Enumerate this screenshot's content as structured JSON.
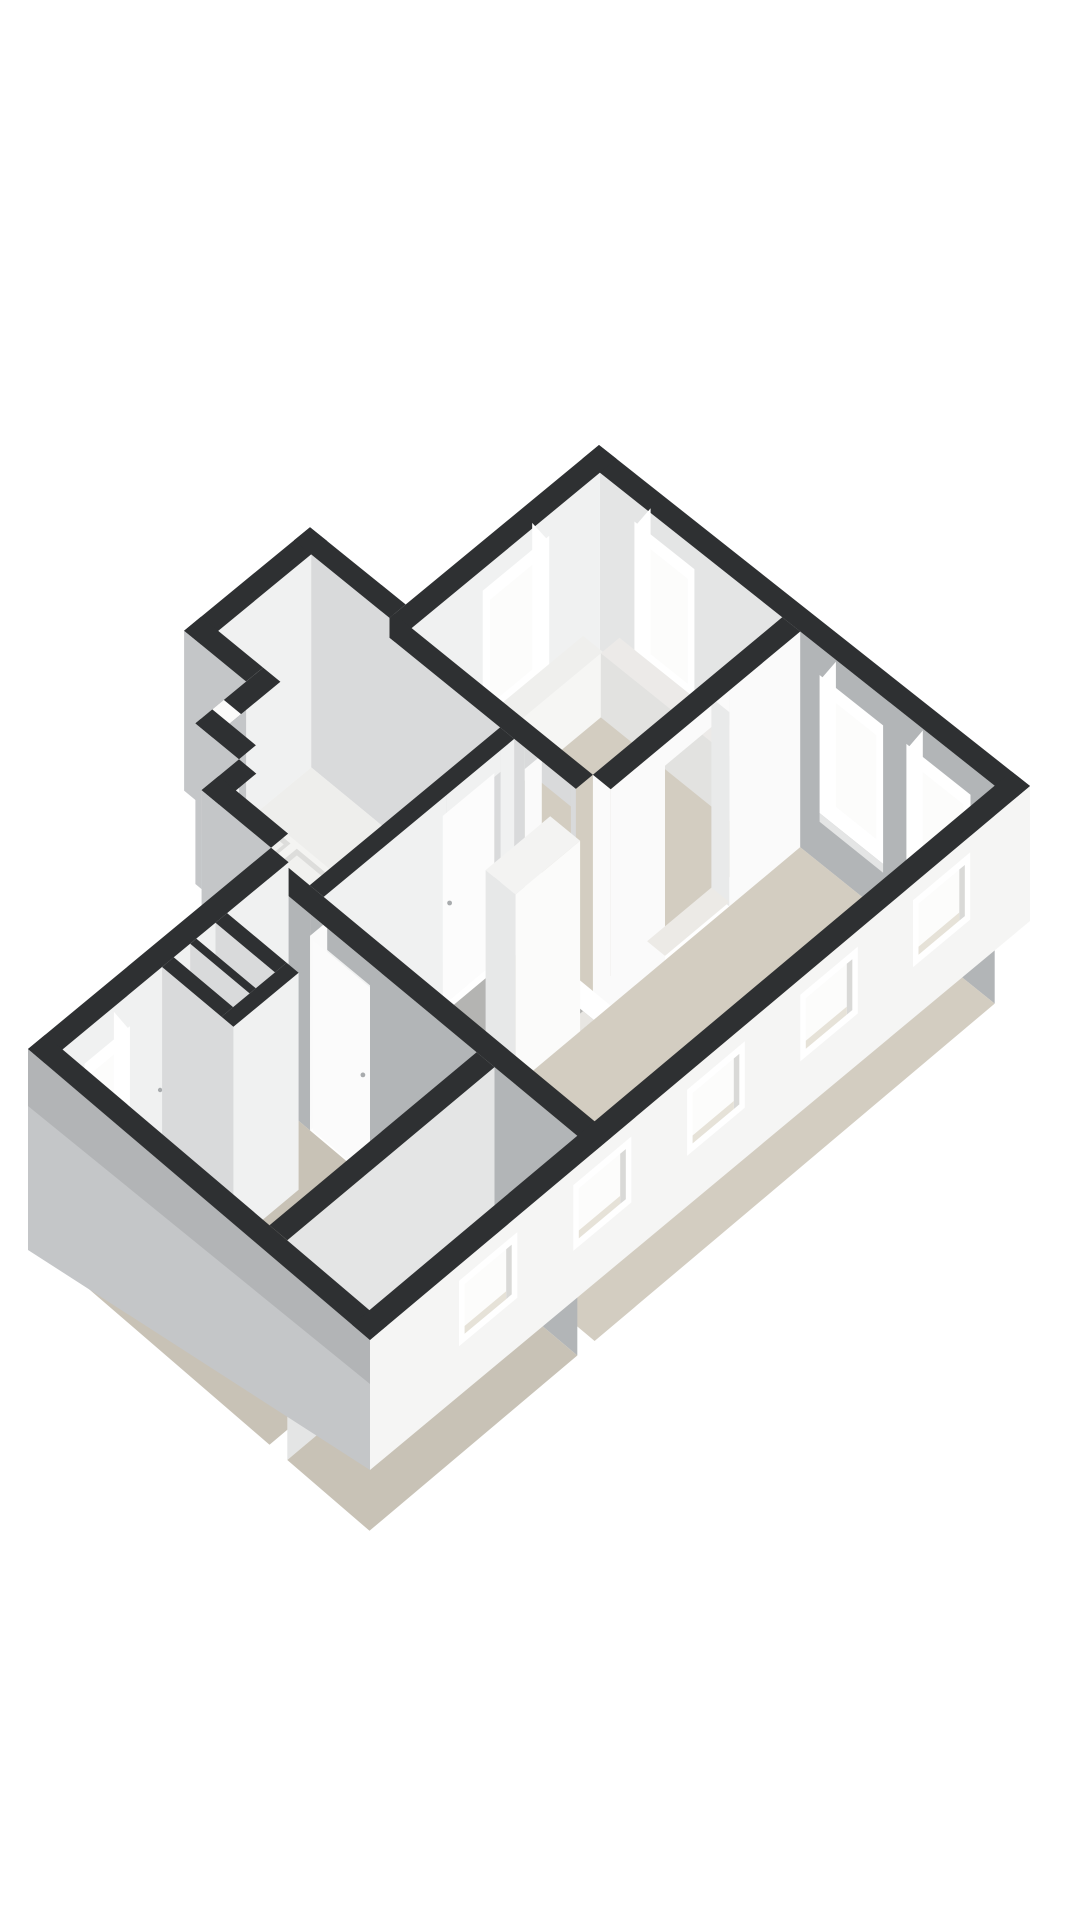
{
  "scene": {
    "description": "isometric-3d-floor-plan-render",
    "background": "#ffffff",
    "colors": {
      "wall_top": "#2e3032",
      "wall_top_edge": "#232527",
      "int_white": "#f0f1f1",
      "int_white_bright": "#fafafa",
      "int_white_dim": "#e4e5e5",
      "int_gray": "#b2b5b7",
      "int_gray_light": "#d9dadb",
      "ext_gray": "#c4c6c8",
      "ext_gray_dark": "#b2b4b6",
      "ext_white": "#f5f5f4",
      "floor_beige": "#d3cdc1",
      "floor_beige_shade": "#c8c2b6",
      "floor_gray": "#b4b4b2",
      "floor_white": "#eeeeec",
      "floor_strip": "#e8e6e2",
      "glass": "#fcfcfb",
      "frame": "#ffffff",
      "frame_line": "#d4d4d2",
      "reveal": "#e9eaea",
      "fixture": "#f6f6f5",
      "fixture_shade": "#e2e2e0",
      "metal": "#a8abad"
    },
    "rooms": [
      {
        "name": "bedroom-north",
        "floor": "beige"
      },
      {
        "name": "living-room",
        "floor": "beige"
      },
      {
        "name": "kitchen",
        "floor": "white"
      },
      {
        "name": "hallway",
        "floor": "gray"
      },
      {
        "name": "bedroom-south",
        "floor": "beige"
      },
      {
        "name": "storage-room",
        "floor": "beige"
      },
      {
        "name": "closets",
        "floor": "white"
      }
    ],
    "fixtures": [
      "kitchen-counter",
      "kitchen-sink-double",
      "kitchen-faucet",
      "toilet",
      "tall-cabinet",
      "window-ledge"
    ],
    "windows": {
      "ne_facade": 3,
      "nw_facade": 1,
      "se_facade": 5,
      "nw_lower_facade": 1
    },
    "doors": {
      "door_openings": 4,
      "door_leafs": 2
    }
  }
}
